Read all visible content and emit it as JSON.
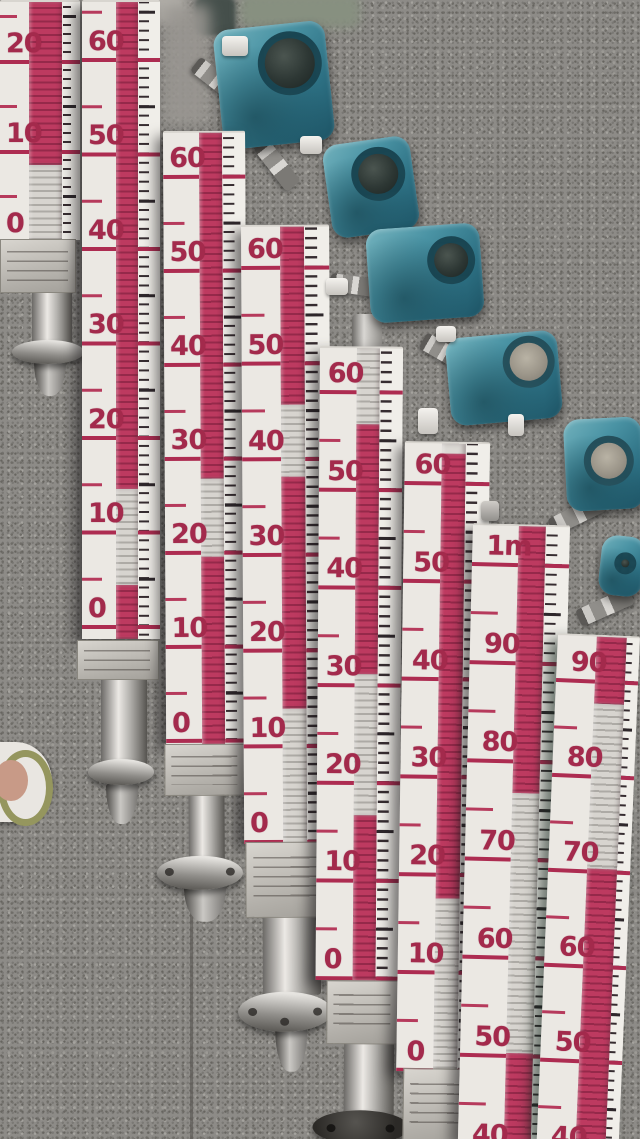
{
  "colors": {
    "transmitter_teal": "#3f8ba0",
    "flap_red": "#b93a5f",
    "scale_number_red": "#a32a4c",
    "board_white": "#edeae5",
    "granite_gray": "#8d8b87",
    "tick_black": "#2e272b"
  },
  "gauges": [
    {
      "id": "gauge-1",
      "labels": [
        "20",
        "10",
        "0"
      ]
    },
    {
      "id": "gauge-2",
      "labels": [
        "60",
        "50",
        "40",
        "30",
        "20",
        "10",
        "0"
      ]
    },
    {
      "id": "gauge-3",
      "labels": [
        "60",
        "50",
        "40",
        "30",
        "20",
        "10",
        "0"
      ]
    },
    {
      "id": "gauge-4",
      "labels": [
        "60",
        "50",
        "40",
        "30",
        "20",
        "10",
        "0"
      ]
    },
    {
      "id": "gauge-5",
      "labels": [
        "60",
        "50",
        "40",
        "30",
        "20",
        "10",
        "0"
      ]
    },
    {
      "id": "gauge-6",
      "labels": [
        "60",
        "50",
        "40",
        "30",
        "20",
        "10",
        "0"
      ]
    },
    {
      "id": "gauge-7",
      "labels": [
        "1m",
        "90",
        "80",
        "70",
        "60",
        "50",
        "40"
      ]
    },
    {
      "id": "gauge-8",
      "labels": [
        "90",
        "80",
        "70",
        "60",
        "50",
        "40"
      ]
    }
  ]
}
